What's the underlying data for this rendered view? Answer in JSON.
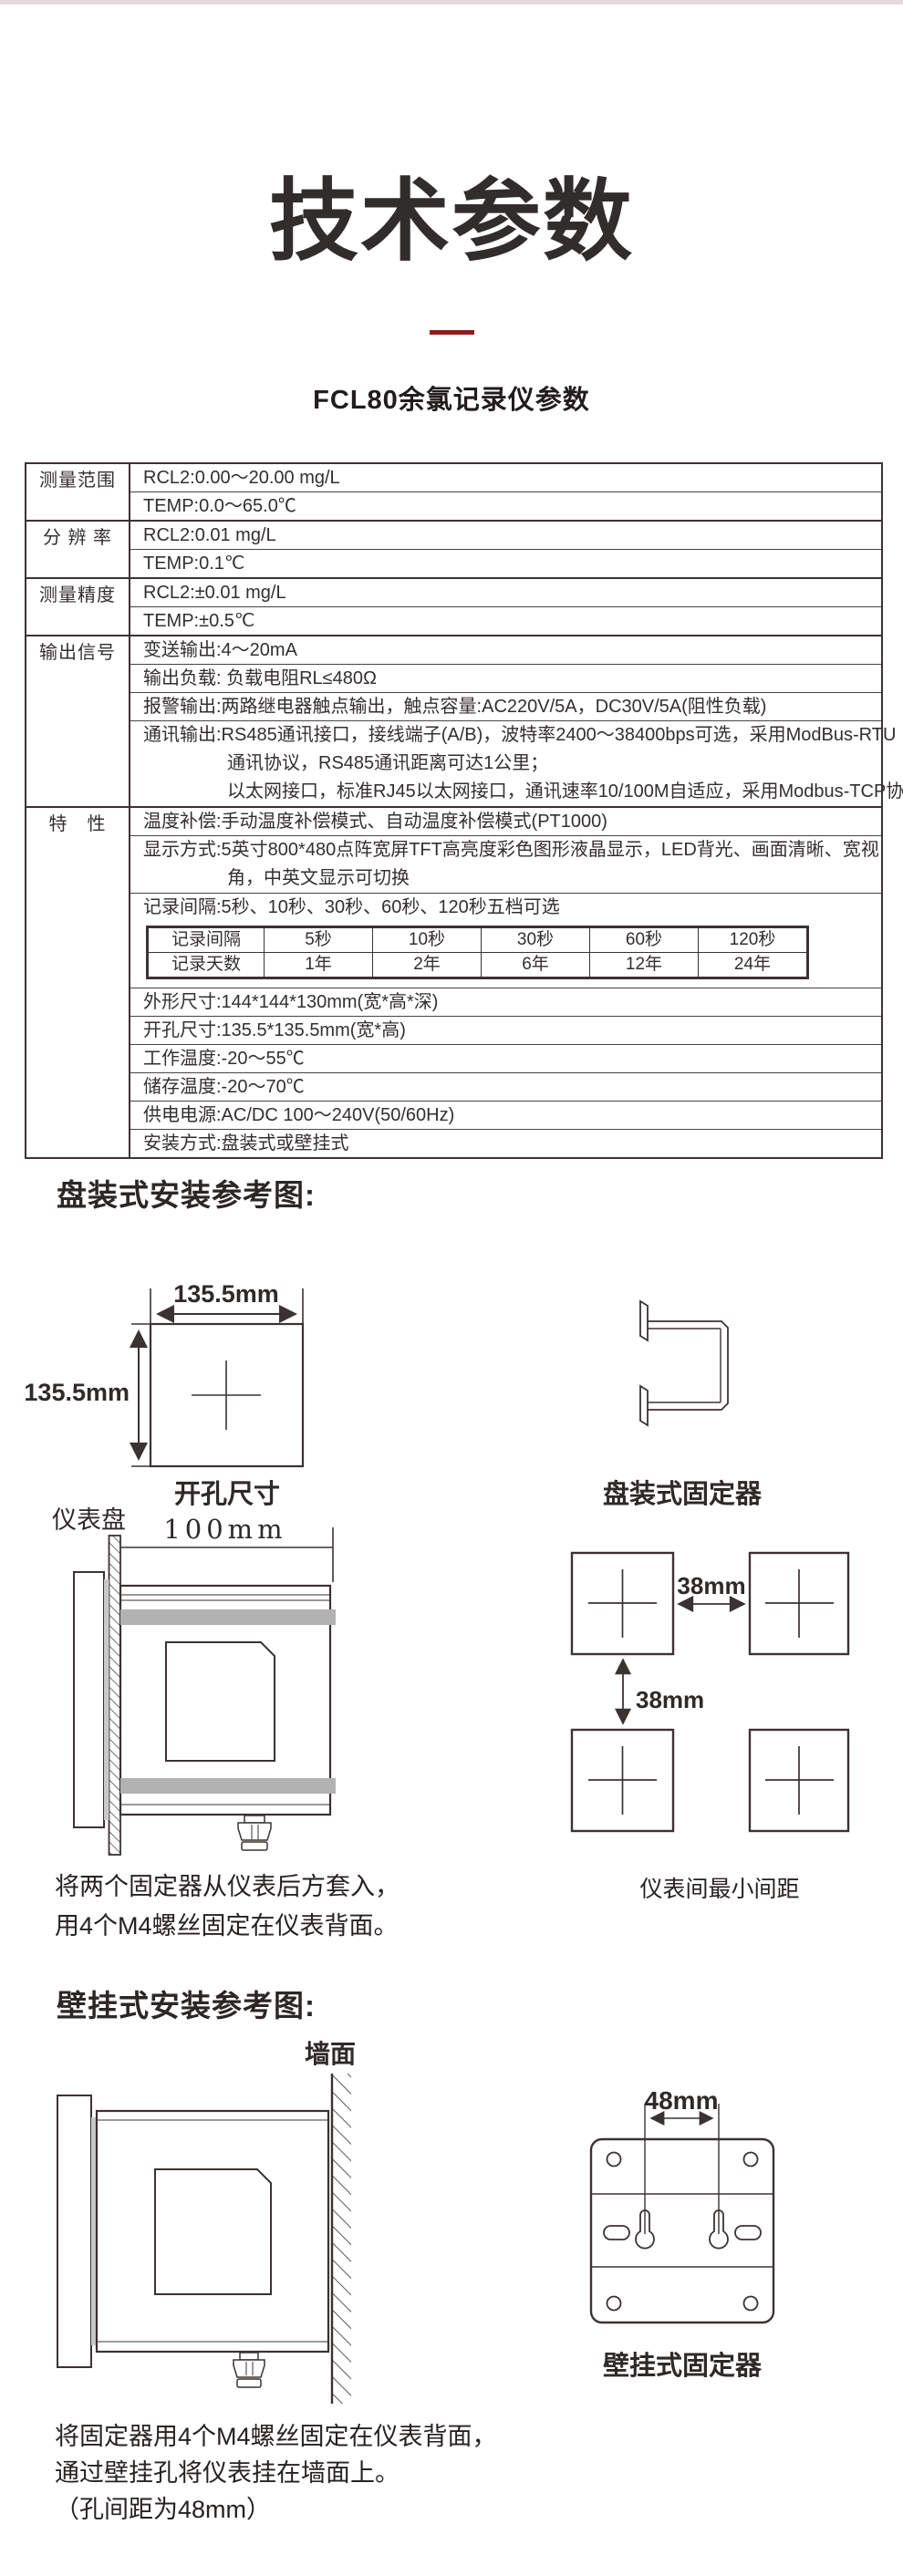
{
  "page": {
    "background": "#ffffff",
    "top_strip_color": "#e2dada",
    "accent_color": "#8e1d1d",
    "ink_color": "#332f2e",
    "band_color": "#b2b2b2"
  },
  "header": {
    "title": "技术参数",
    "subtitle": "FCL80余氯记录仪参数"
  },
  "spec_table": {
    "groups": [
      {
        "label": "测量范围",
        "rows": [
          [
            "RCL2:0.00～20.00 mg/L"
          ],
          [
            "TEMP:0.0～65.0℃"
          ]
        ]
      },
      {
        "label": "分 辨 率",
        "rows": [
          [
            "RCL2:0.01 mg/L"
          ],
          [
            "TEMP:0.1℃"
          ]
        ]
      },
      {
        "label": "测量精度",
        "rows": [
          [
            "RCL2:±0.01 mg/L"
          ],
          [
            "TEMP:±0.5℃"
          ]
        ]
      },
      {
        "label": "输出信号",
        "rows": [
          [
            "变送输出:4～20mA"
          ],
          [
            "输出负载: 负载电阻RL≤480Ω"
          ],
          [
            "报警输出:两路继电器触点输出，触点容量:AC220V/5A，DC30V/5A(阻性负载)"
          ],
          [
            "通讯输出:RS485通讯接口，接线端子(A/B)，波特率2400～38400bps可选，采用ModBus-RTU",
            "通讯协议，RS485通讯距离可达1公里；",
            "以太网接口，标准RJ45以太网接口，通讯速率10/100M自适应，采用Modbus-TCP协议"
          ]
        ]
      },
      {
        "label": "特　性",
        "rows": [
          [
            "温度补偿:手动温度补偿模式、自动温度补偿模式(PT1000)"
          ],
          [
            "显示方式:5英寸800*480点阵宽屏TFT高亮度彩色图形液晶显示，LED背光、画面清晰、宽视",
            "角，中英文显示可切换"
          ],
          [
            "记录间隔:5秒、10秒、30秒、60秒、120秒五档可选"
          ],
          [
            "外形尺寸:144*144*130mm(宽*高*深)"
          ],
          [
            "开孔尺寸:135.5*135.5mm(宽*高)"
          ],
          [
            "工作温度:-20～55℃"
          ],
          [
            "储存温度:-20～70℃"
          ],
          [
            "供电电源:AC/DC 100～240V(50/60Hz)"
          ],
          [
            "安装方式:盘装式或壁挂式"
          ]
        ]
      }
    ],
    "record_table": {
      "header": [
        "记录间隔",
        "5秒",
        "10秒",
        "30秒",
        "60秒",
        "120秒"
      ],
      "days": [
        "记录天数",
        "1年",
        "2年",
        "6年",
        "12年",
        "24年"
      ]
    }
  },
  "panel_section": {
    "heading": "盘装式安装参考图:",
    "cutout_width_label": "135.5mm",
    "cutout_height_label": "135.5mm",
    "cutout_caption": "开孔尺寸",
    "fixer_caption": "盘装式固定器",
    "panel_label": "仪表盘",
    "depth_label": "100mm",
    "spacing_h_label": "38mm",
    "spacing_v_label": "38mm",
    "spacing_caption": "仪表间最小间距",
    "note": [
      "将两个固定器从仪表后方套入，",
      "用4个M4螺丝固定在仪表背面。"
    ]
  },
  "wall_section": {
    "heading": "壁挂式安装参考图:",
    "wall_label": "墙面",
    "hole_spacing_label": "48mm",
    "fixer_caption": "壁挂式固定器",
    "note": [
      "将固定器用4个M4螺丝固定在仪表背面，",
      "通过壁挂孔将仪表挂在墙面上。",
      "（孔间距为48mm）"
    ]
  }
}
